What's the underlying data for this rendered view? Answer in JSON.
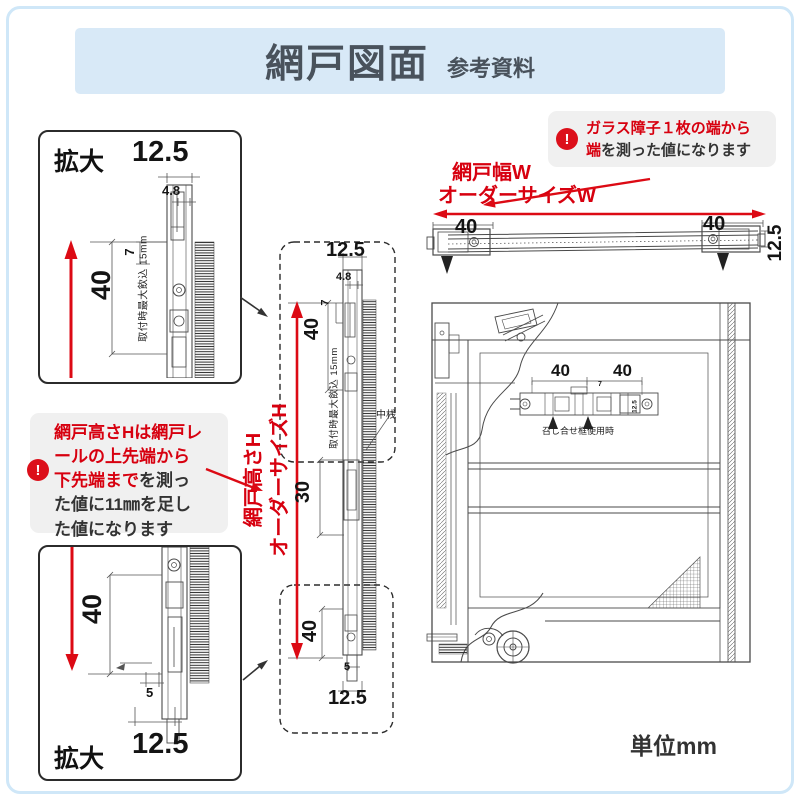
{
  "header": {
    "title": "網戸図面",
    "subtitle": "参考資料"
  },
  "notes": {
    "unit": "単位mm"
  },
  "colors": {
    "accent_red": "#d7000f",
    "banner_blue": "#d8e9f7",
    "border_blue": "#cfe7f8",
    "callout_gray": "#f0f0f0",
    "ink": "#333333"
  },
  "callout_width": {
    "icon": "alert-icon",
    "line1": "ガラス障子１枚の端から",
    "line2_red": "端",
    "line2_rest": "を測った値になります"
  },
  "callout_height": {
    "icon": "alert-icon",
    "seg1": "網戸高さHは網戸レ",
    "seg2": "ールの上先端から",
    "seg3_red": "下先端まで",
    "seg3_rest": "を測っ",
    "seg4": "た値に11㎜を足し",
    "seg5": "た値になります"
  },
  "width_label": {
    "line1": "網戸幅W",
    "line2": "オーダーサイズW"
  },
  "height_label": {
    "line1": "網戸高さH",
    "line2": "オーダーサイズH"
  },
  "top_view": {
    "dim_left": "40",
    "dim_right": "40",
    "dim_depth": "12.5"
  },
  "detail_top": {
    "title": "拡大",
    "dim_width": "12.5",
    "dim_slot": "4.8",
    "dim_hook": "7",
    "dim_height": "40",
    "note": "取付時最大飲込 15mm"
  },
  "detail_bottom": {
    "title": "拡大",
    "dim_height": "40",
    "dim_offset": "5",
    "dim_width": "12.5"
  },
  "section": {
    "dim_width_top": "12.5",
    "dim_slot": "4.8",
    "dim_hook": "7",
    "dim_top": "40",
    "note": "取付時最大飲込 15mm",
    "dim_mid": "30",
    "mid_rail_label": "中桟",
    "dim_bottom": "40",
    "dim_offset": "5",
    "dim_width_bottom": "12.5"
  },
  "front_view": {
    "dim_left": "40",
    "dim_right": "40",
    "dim_small": "7",
    "dim_depth": "12.5",
    "meeting_label": "召し合せ框使用時"
  }
}
